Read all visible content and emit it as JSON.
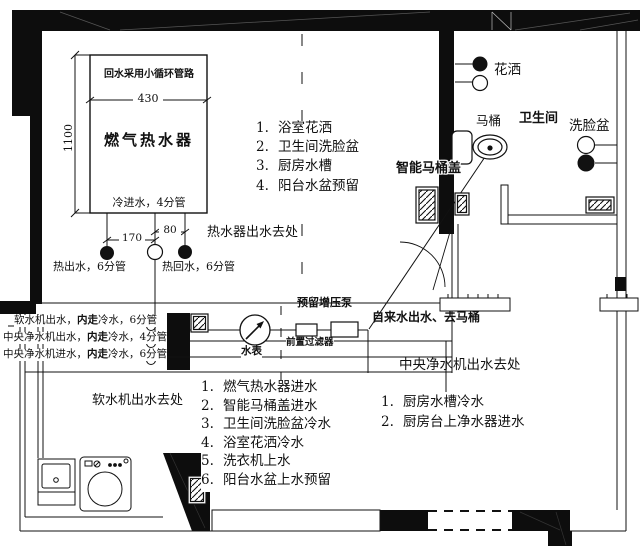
{
  "colors": {
    "ink": "#111111",
    "paper": "#ffffff"
  },
  "heater": {
    "note": "回水采用小循环管路",
    "name": "燃气热水器",
    "width_dim": "430",
    "height_dim": "1100",
    "cold_inlet": "冷进水，4分管",
    "dim_170": "170",
    "dim_80": "80",
    "hot_out": "热出水，6分管",
    "hot_return": "热回水，6分管"
  },
  "hot_water": {
    "title": "热水器出水去处",
    "items": [
      {
        "num": "1.",
        "label": "浴室花洒"
      },
      {
        "num": "2.",
        "label": "卫生间洗脸盆"
      },
      {
        "num": "3.",
        "label": "厨房水槽"
      },
      {
        "num": "4.",
        "label": "阳台水盆预留"
      }
    ]
  },
  "left_pipes": {
    "lines": [
      {
        "pre": "软水机出水，",
        "bold": "内走",
        "post": "冷水，6分管"
      },
      {
        "pre": "中央净水机出水，",
        "bold": "内走",
        "post": "冷水，4分管"
      },
      {
        "pre": "中央净水机进水，",
        "bold": "内走",
        "post": "冷水，6分管"
      }
    ]
  },
  "soft_water": {
    "title": "软水机出水去处",
    "items": [
      {
        "num": "1.",
        "label": "燃气热水器进水"
      },
      {
        "num": "2.",
        "label": "智能马桶盖进水"
      },
      {
        "num": "3.",
        "label": "卫生间洗脸盆冷水"
      },
      {
        "num": "4.",
        "label": "浴室花洒冷水"
      },
      {
        "num": "5.",
        "label": "洗衣机上水"
      },
      {
        "num": "6.",
        "label": "阳台水盆上水预留"
      }
    ]
  },
  "central_water": {
    "title": "中央净水机出水去处",
    "items": [
      {
        "num": "1.",
        "label": "厨房水槽冷水"
      },
      {
        "num": "2.",
        "label": "厨房台上净水器进水"
      }
    ]
  },
  "corridor": {
    "meter_label": "水表",
    "filter_label": "前置过滤器",
    "reserved_pump": "预留增压泵",
    "tap_water": "自来水出水、去马桶"
  },
  "bathroom": {
    "room_label": "卫生间",
    "shower_label": "花洒",
    "basin_label": "洗脸盆",
    "toilet_label": "马桶",
    "smart_lid_label": "智能马桶盖"
  }
}
